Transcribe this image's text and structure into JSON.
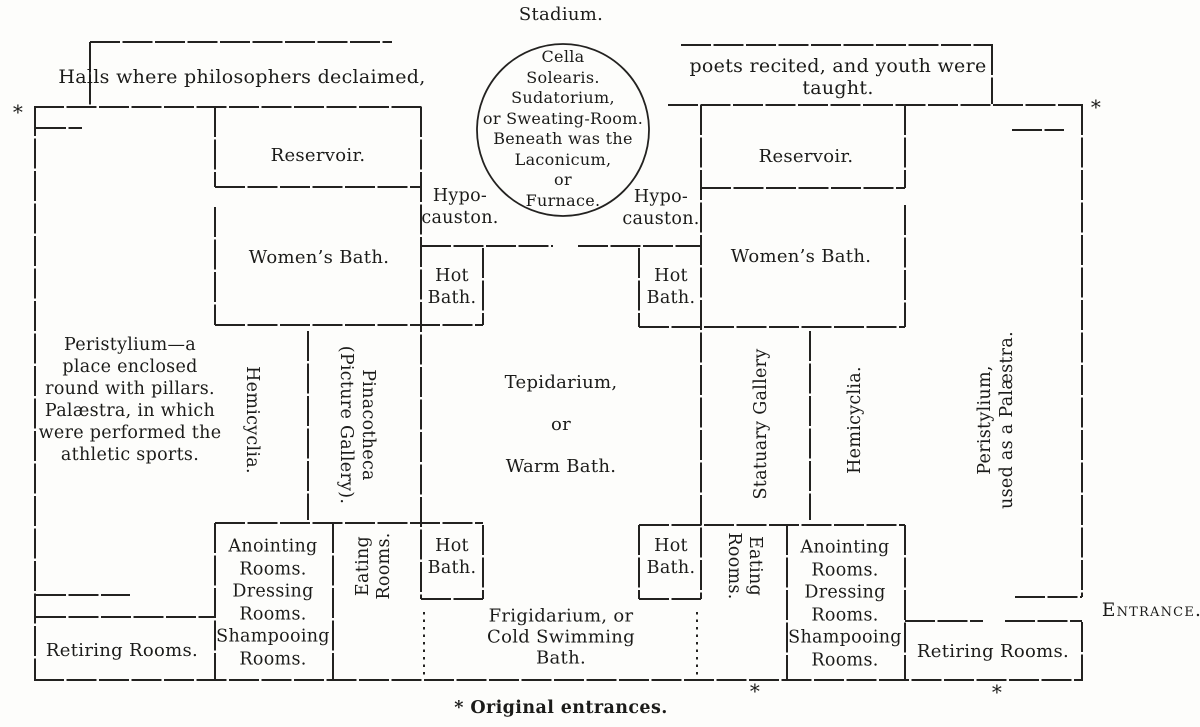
{
  "figure": {
    "title": "Stadium.",
    "caption": "* Original entrances.",
    "entrance": "Entrance.",
    "asterisk": "*"
  },
  "halls": {
    "left": "Halls where philosophers declaimed,",
    "right": "poets recited, and youth were taught."
  },
  "rooms": {
    "cella": "Cella\nSolearis.\nSudatorium,\nor Sweating-Room.\nBeneath was the\nLaconicum,\nor\nFurnace.",
    "hypocauston": "Hypo-\ncauston.",
    "reservoir": "Reservoir.",
    "womens_bath": "Women’s Bath.",
    "hot_bath": "Hot\nBath.",
    "peristylium_left": "Peristylium—a\nplace enclosed\nround with pillars.\nPalæstra, in which\nwere performed the\nathletic sports.",
    "hemicyclia": "Hemicyclia.",
    "pinacotheca": "Pinacotheca\n(Picture Gallery).",
    "tepidarium": "Tepidarium,\nor\nWarm Bath.",
    "statuary_gallery": "Statuary Gallery",
    "peristylium_right": "Peristylium,\nused as a Palæstra.",
    "anointing": "Anointing\nRooms.\nDressing\nRooms.\nShampooing\nRooms.",
    "eating": "Eating\nRooms.",
    "frigidarium": "Frigidarium, or\nCold Swimming\nBath.",
    "retiring": "Retiring Rooms."
  }
}
